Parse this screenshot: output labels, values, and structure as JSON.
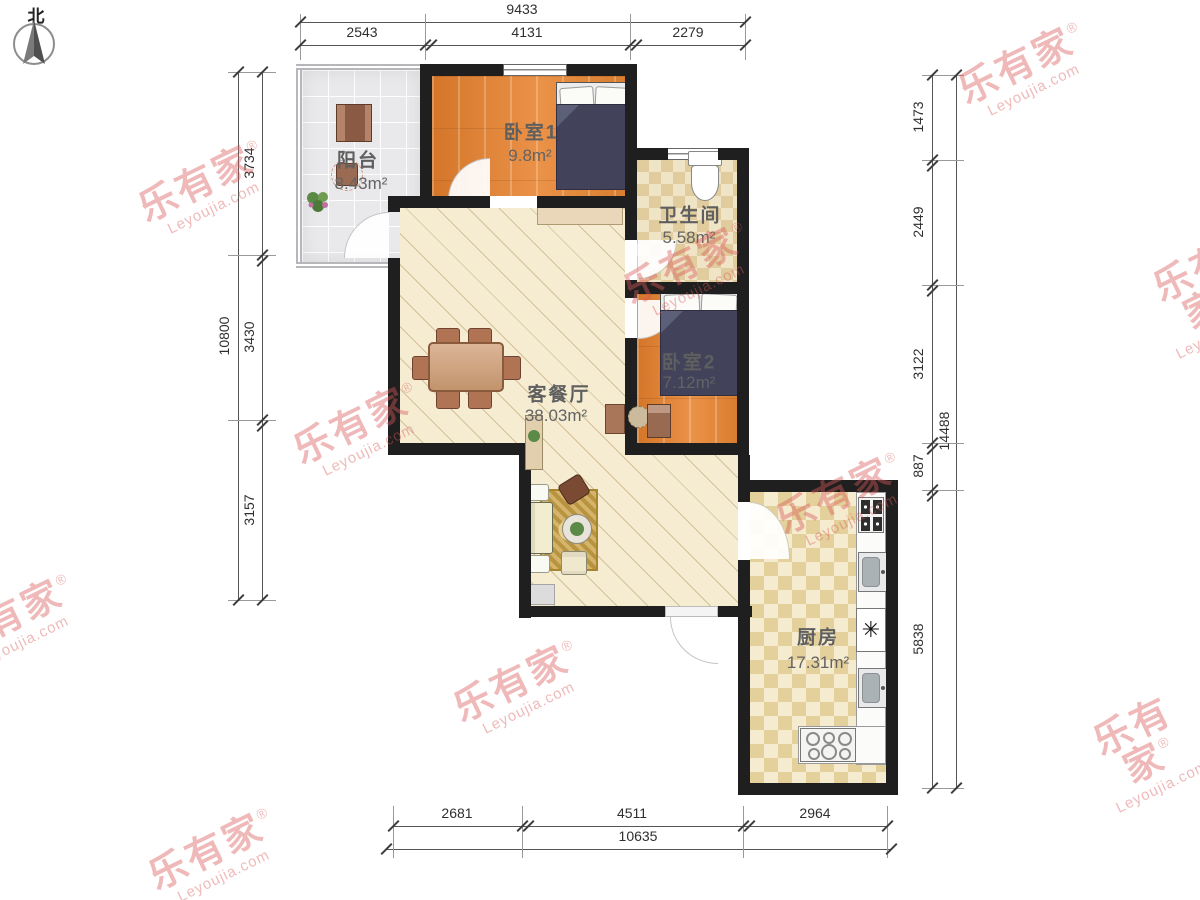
{
  "compass": {
    "label": "北"
  },
  "watermark": {
    "brand": "乐有家",
    "registered": "®",
    "domain": "Leyoujia.com"
  },
  "rooms": {
    "balcony": {
      "name": "阳台",
      "area": "8.43m²"
    },
    "bedroom1": {
      "name": "卧室1",
      "area": "9.8m²"
    },
    "bathroom": {
      "name": "卫生间",
      "area": "5.58m²"
    },
    "bedroom2": {
      "name": "卧室2",
      "area": "7.12m²"
    },
    "living": {
      "name": "客餐厅",
      "area": "38.03m²"
    },
    "kitchen": {
      "name": "厨房",
      "area": "17.31m²"
    }
  },
  "dimensions": {
    "top": {
      "total": "9433",
      "segments": [
        "2543",
        "4131",
        "2279"
      ]
    },
    "left": {
      "total": "10800",
      "segments": [
        "3734",
        "3430",
        "3157"
      ]
    },
    "right": {
      "total": "14488",
      "segments": [
        "1473",
        "2449",
        "3122",
        "887",
        "5838"
      ]
    },
    "bottom": {
      "total": "10635",
      "segments": [
        "2681",
        "4511",
        "2964"
      ]
    }
  },
  "colors": {
    "wall": "#1f1f1f",
    "watermark": "#d85858",
    "bedroom_floor": "#dd8130",
    "living_floor": "#f5ecd2",
    "kitchen_floor": "#efe1b3",
    "bath_floor": "#e9d9ae",
    "balcony_floor": "#e9e9ec"
  }
}
